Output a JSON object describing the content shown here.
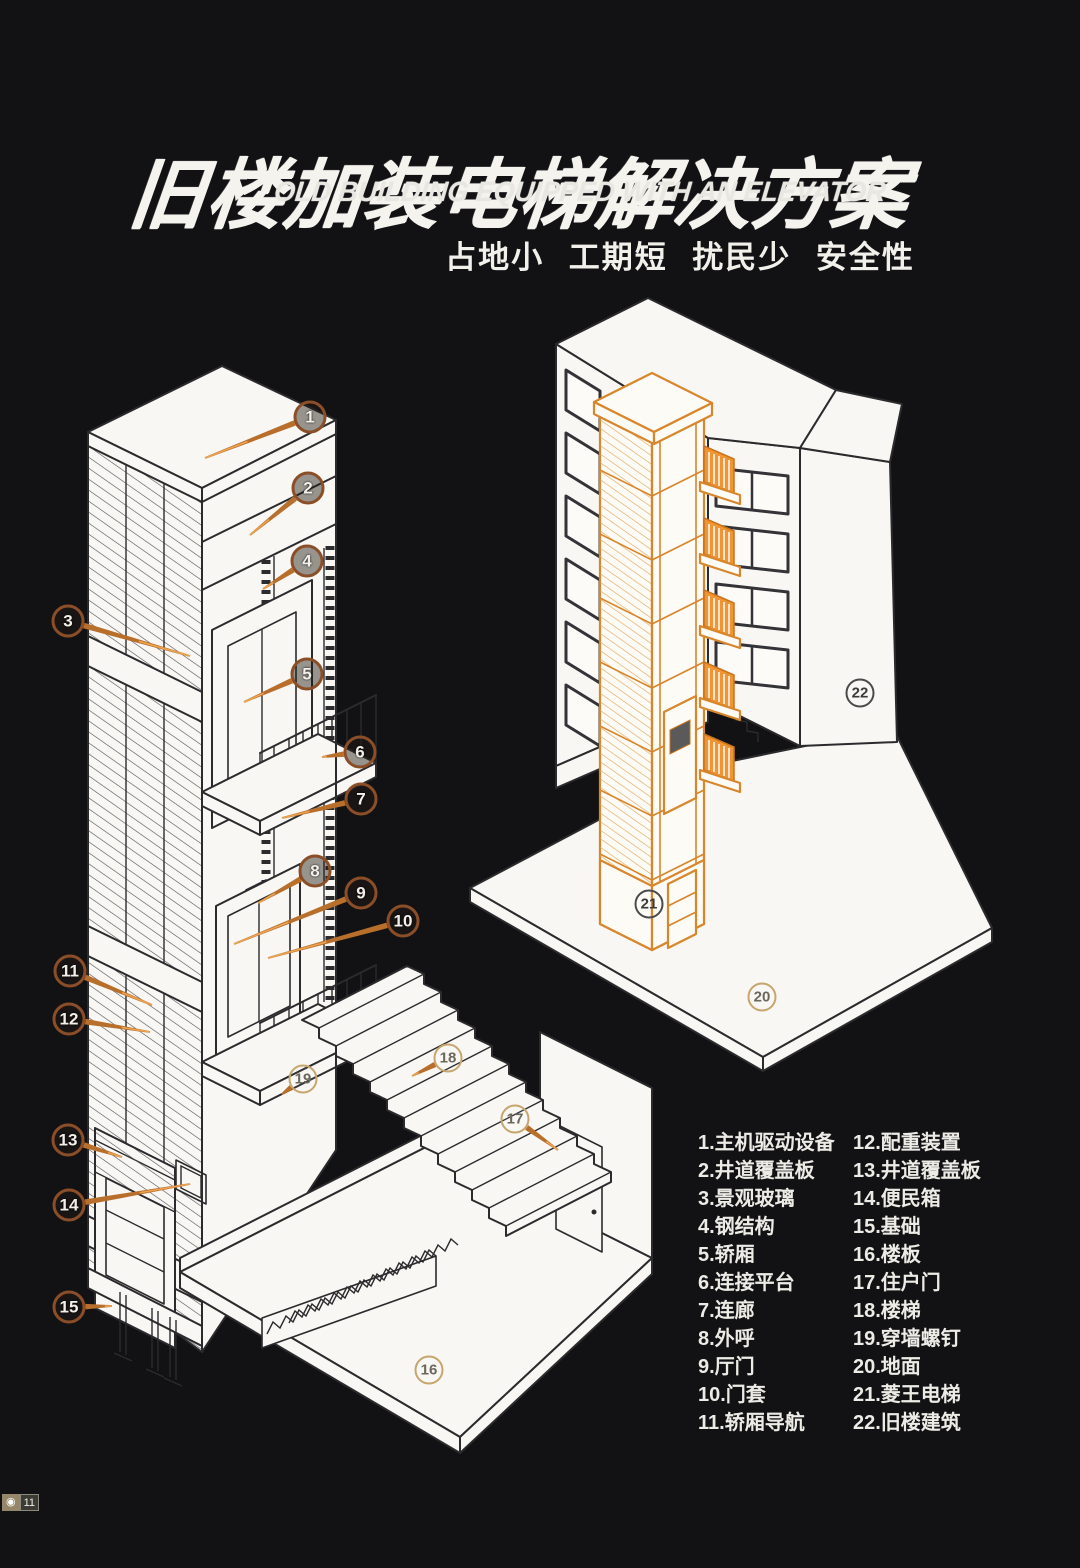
{
  "title": {
    "zh": "旧楼加装电梯解决方案",
    "en": "OLD BUILDING EQUIPPED WITH AN ELEVATOR",
    "tagline": "占地小 工期短 扰民少 安全性"
  },
  "legend": {
    "columns": [
      {
        "items": [
          {
            "num": "1",
            "label": "主机驱动设备"
          },
          {
            "num": "2",
            "label": "井道覆盖板"
          },
          {
            "num": "3",
            "label": "景观玻璃"
          },
          {
            "num": "4",
            "label": "钢结构"
          },
          {
            "num": "5",
            "label": "轿厢"
          },
          {
            "num": "6",
            "label": "连接平台"
          },
          {
            "num": "7",
            "label": "连廊"
          },
          {
            "num": "8",
            "label": "外呼"
          },
          {
            "num": "9",
            "label": "厅门"
          },
          {
            "num": "10",
            "label": "门套"
          },
          {
            "num": "11",
            "label": "轿厢导航"
          }
        ]
      },
      {
        "items": [
          {
            "num": "12",
            "label": "配重装置"
          },
          {
            "num": "13",
            "label": "井道覆盖板"
          },
          {
            "num": "14",
            "label": "便民箱"
          },
          {
            "num": "15",
            "label": "基础"
          },
          {
            "num": "16",
            "label": "楼板"
          },
          {
            "num": "17",
            "label": "住户门"
          },
          {
            "num": "18",
            "label": "楼梯"
          },
          {
            "num": "19",
            "label": "穿墙螺钉"
          },
          {
            "num": "20",
            "label": "地面"
          },
          {
            "num": "21",
            "label": "菱王电梯"
          },
          {
            "num": "22",
            "label": "旧楼建筑"
          }
        ]
      }
    ]
  },
  "callouts": [
    {
      "n": "1",
      "x": 310,
      "y": 417,
      "style": "dark",
      "lx": 205,
      "ly": 458
    },
    {
      "n": "2",
      "x": 308,
      "y": 488,
      "style": "dark",
      "lx": 250,
      "ly": 535
    },
    {
      "n": "3",
      "x": 68,
      "y": 621,
      "style": "dark",
      "lx": 190,
      "ly": 656
    },
    {
      "n": "4",
      "x": 307,
      "y": 561,
      "style": "dark",
      "lx": 263,
      "ly": 589
    },
    {
      "n": "5",
      "x": 307,
      "y": 674,
      "style": "dark",
      "lx": 244,
      "ly": 702
    },
    {
      "n": "6",
      "x": 360,
      "y": 752,
      "style": "dark",
      "lx": 322,
      "ly": 757
    },
    {
      "n": "7",
      "x": 361,
      "y": 799,
      "style": "dark",
      "lx": 282,
      "ly": 818
    },
    {
      "n": "8",
      "x": 315,
      "y": 871,
      "style": "dark",
      "lx": 258,
      "ly": 903
    },
    {
      "n": "9",
      "x": 361,
      "y": 893,
      "style": "dark",
      "lx": 234,
      "ly": 944
    },
    {
      "n": "10",
      "x": 403,
      "y": 921,
      "style": "dark",
      "lx": 268,
      "ly": 958
    },
    {
      "n": "11",
      "x": 70,
      "y": 971,
      "style": "dark",
      "lx": 152,
      "ly": 1005
    },
    {
      "n": "12",
      "x": 69,
      "y": 1019,
      "style": "dark",
      "lx": 150,
      "ly": 1032
    },
    {
      "n": "13",
      "x": 68,
      "y": 1140,
      "style": "dark",
      "lx": 122,
      "ly": 1157
    },
    {
      "n": "14",
      "x": 69,
      "y": 1205,
      "style": "dark",
      "lx": 190,
      "ly": 1184
    },
    {
      "n": "15",
      "x": 69,
      "y": 1307,
      "style": "dark",
      "lx": 112,
      "ly": 1306
    },
    {
      "n": "16",
      "x": 429,
      "y": 1370,
      "style": "light"
    },
    {
      "n": "17",
      "x": 515,
      "y": 1119,
      "style": "light",
      "lx": 558,
      "ly": 1150
    },
    {
      "n": "18",
      "x": 448,
      "y": 1058,
      "style": "light",
      "lx": 412,
      "ly": 1076
    },
    {
      "n": "19",
      "x": 303,
      "y": 1079,
      "style": "light",
      "lx": 282,
      "ly": 1094
    },
    {
      "n": "20",
      "x": 762,
      "y": 997,
      "style": "light"
    },
    {
      "n": "21",
      "x": 649,
      "y": 904,
      "style": "ink"
    },
    {
      "n": "22",
      "x": 860,
      "y": 693,
      "style": "ink"
    }
  ],
  "watermark": {
    "icon_glyph": "◉",
    "count": "11"
  },
  "palette": {
    "background": "#121215",
    "paper": "#f8f7f3",
    "line": "#2b2b2e",
    "orange": "#d8862c",
    "bridge_orange": "#f09434",
    "callout_dark_ring": "#8a4e28",
    "callout_light_ring": "#c6a66e",
    "leader": "#b96f2c"
  }
}
